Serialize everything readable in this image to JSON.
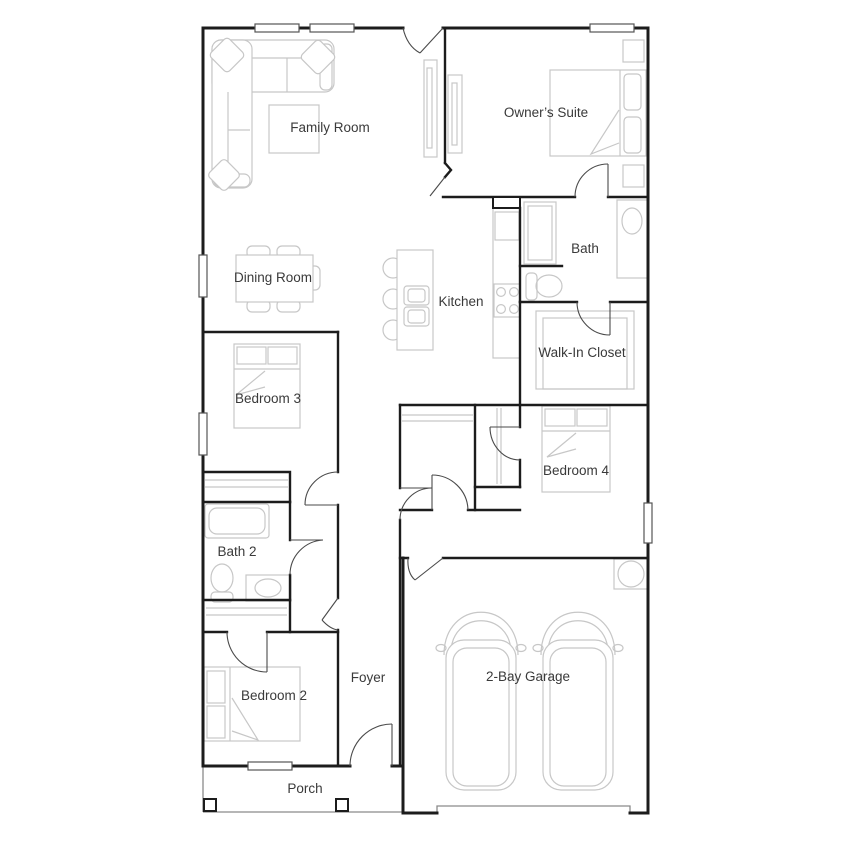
{
  "plan": {
    "type": "residential-floor-plan",
    "rooms": [
      {
        "id": "family-room",
        "label": "Family Room"
      },
      {
        "id": "owners-suite",
        "label": "Owner’s Suite"
      },
      {
        "id": "dining-room",
        "label": "Dining Room"
      },
      {
        "id": "kitchen",
        "label": "Kitchen"
      },
      {
        "id": "bath",
        "label": "Bath"
      },
      {
        "id": "walk-in-closet",
        "label": "Walk-In Closet"
      },
      {
        "id": "bedroom-3",
        "label": "Bedroom 3"
      },
      {
        "id": "bedroom-4",
        "label": "Bedroom 4"
      },
      {
        "id": "bath-2",
        "label": "Bath 2"
      },
      {
        "id": "foyer",
        "label": "Foyer"
      },
      {
        "id": "bedroom-2",
        "label": "Bedroom 2"
      },
      {
        "id": "porch",
        "label": "Porch"
      },
      {
        "id": "garage",
        "label": "2-Bay Garage"
      }
    ],
    "colors": {
      "wall": "#1c1c1c",
      "furniture": "#c7c7c7",
      "door": "#4a4a4a",
      "text": "#3a3a3a",
      "background": "#ffffff"
    }
  }
}
